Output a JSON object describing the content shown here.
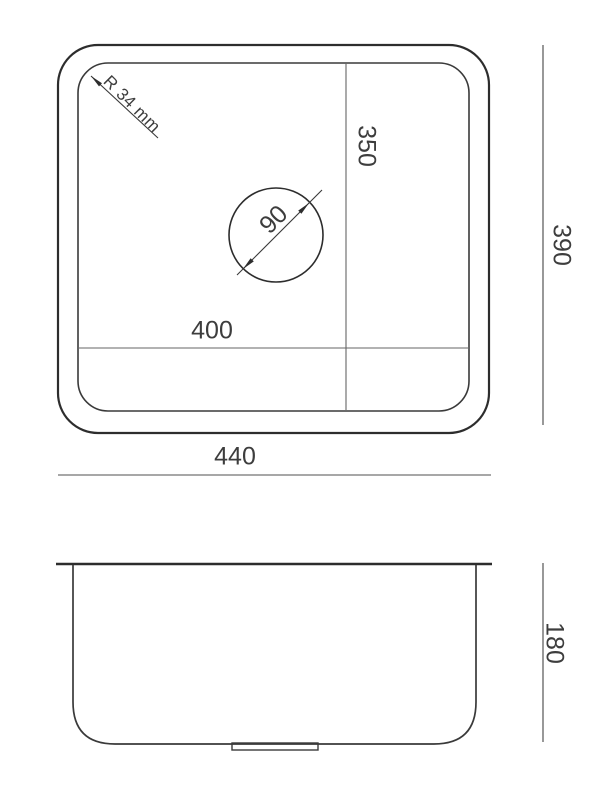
{
  "drawing": {
    "title": "sink-dimension-drawing",
    "top_view": {
      "labels": {
        "outer_width": "440",
        "outer_height": "390",
        "inner_width": "400",
        "inner_height": "350",
        "drain_diameter": "90",
        "corner_radius": "R 34 mm"
      }
    },
    "side_view": {
      "labels": {
        "bowl_depth": "180"
      }
    },
    "colors": {
      "outline_dark": "#2d2d2d",
      "outline_medium": "#3a3a3a",
      "dimension_line": "#666666",
      "dimension_line_light": "#8a8a8a",
      "text": "#3d3d3d",
      "background": "#ffffff"
    }
  }
}
